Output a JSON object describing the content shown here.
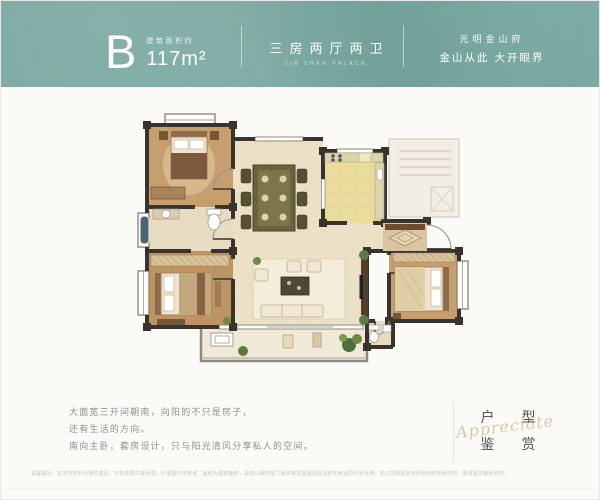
{
  "header": {
    "unit_letter": "B",
    "area_label": "建筑面积约",
    "area_value": "117m²",
    "layout_cn": "三房两厅两卫",
    "layout_en": "JIN SHAN PALACE",
    "slogan_line1": "光明金山府",
    "slogan_line2": "金山从此 大开眼界"
  },
  "colors": {
    "header_teal": "#79a8a0",
    "card_white": "#fbfaf7",
    "seal_gold": "#c9b68a",
    "wall_dark": "#38332c",
    "floor_tan": "#c79e6e",
    "floor_cream": "#ece1c6",
    "kitchen_yellow": "#e9dc9c",
    "bath_beige": "#e7dcc1"
  },
  "description": {
    "line1": "大面宽三开间朝南，向阳的不只是房子，",
    "line2": "还有生活的方向。",
    "line3": "南向主卧，套房设计，只与阳光清风分享私人的空间。"
  },
  "seal": {
    "char1": "户",
    "char2": "型",
    "char3": "鉴",
    "char4": "赏",
    "script_text": "Appreciate"
  },
  "disclaimer": "温馨提示：本宣传资料为要约邀请，不构成要约或承诺；户型图仅供参考，面积为建筑面积，具体以政府部门最终审定图纸及商品房买卖合同约定为准；本公司保留对宣传资料的修改权利，敬请留意最新资料。"
}
